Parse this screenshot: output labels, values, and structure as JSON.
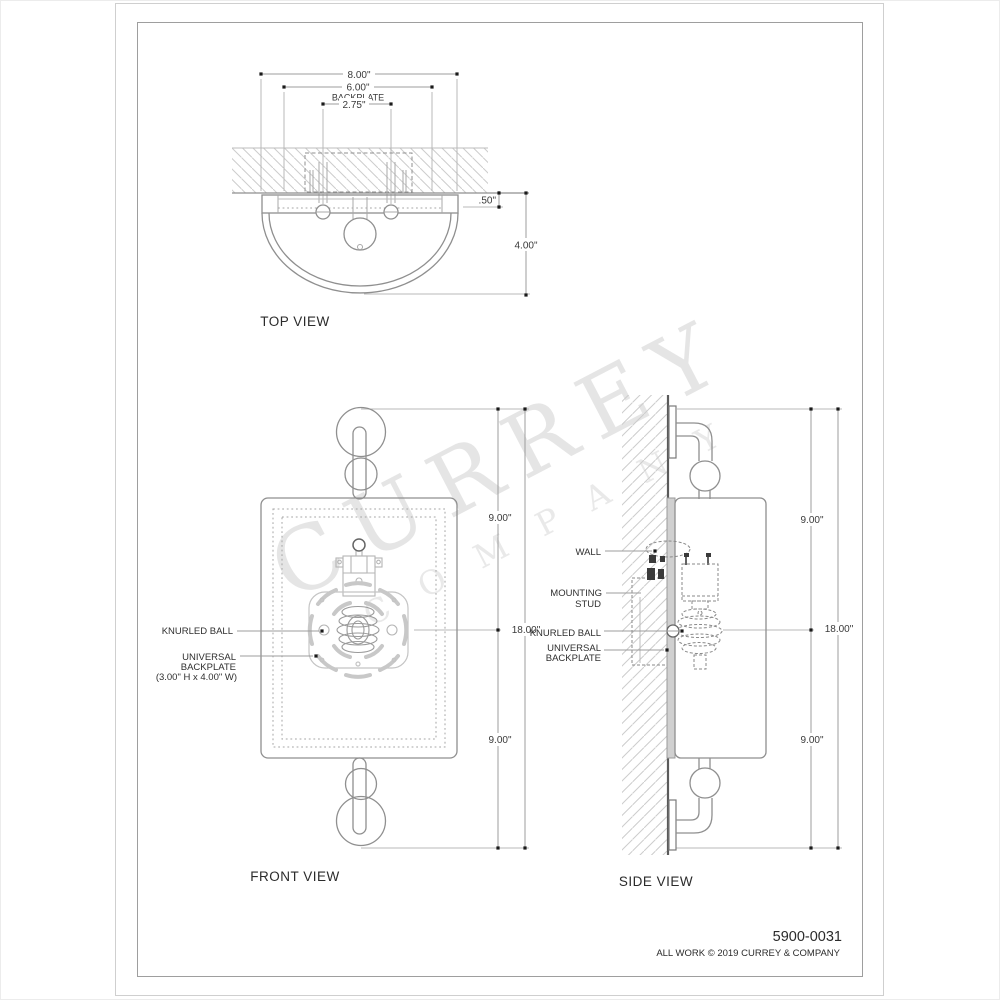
{
  "sheet": {
    "product_number": "5900-0031",
    "copyright_notice": "ALL WORK © 2019 CURREY & COMPANY",
    "watermark": {
      "line1": "CURREY",
      "line2": "COMPANY"
    }
  },
  "top_view": {
    "title": "TOP VIEW",
    "dim_overall_width": "8.00\"",
    "dim_backplate_width": "6.00\"",
    "dim_backplate_caption": "BACKPLATE",
    "dim_stud_spacing": "2.75\"",
    "dim_plate_thickness": ".50\"",
    "dim_projection": "4.00\""
  },
  "front_view": {
    "title": "FRONT VIEW",
    "dim_upper_half": "9.00\"",
    "dim_overall_height": "18.00\"",
    "dim_lower_half": "9.00\"",
    "callout_knurled_ball": "KNURLED BALL",
    "callout_universal_1": "UNIVERSAL",
    "callout_universal_2": "BACKPLATE",
    "callout_universal_3": "(3.00\" H x 4.00\" W)"
  },
  "side_view": {
    "title": "SIDE VIEW",
    "dim_upper_half": "9.00\"",
    "dim_overall_height": "18.00\"",
    "dim_lower_half": "9.00\"",
    "callout_wall": "WALL",
    "callout_mounting_stud_1": "MOUNTING",
    "callout_mounting_stud_2": "STUD",
    "callout_knurled_ball": "KNURLED BALL",
    "callout_universal_1": "UNIVERSAL",
    "callout_universal_2": "BACKPLATE"
  },
  "colors": {
    "line": "#8f8f8f",
    "dim_line": "#9c9c9c",
    "wall_line": "#555555",
    "hatch": "#cccccc",
    "text": "#333333",
    "watermark": "#dddddd"
  }
}
